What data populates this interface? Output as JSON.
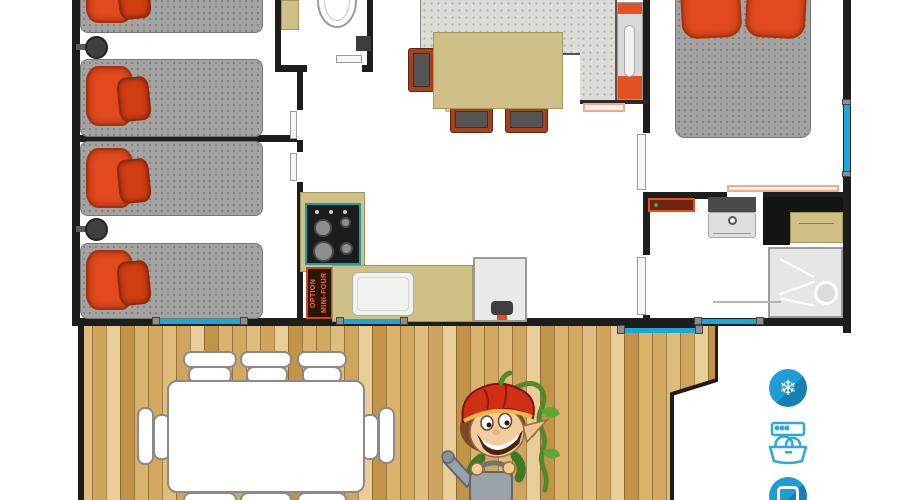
{
  "floorplan": {
    "kitchen": {
      "oven_option_label": "OPTION MINI-FOUR"
    },
    "amenities": [
      {
        "id": "air-conditioning",
        "glyph": "❄"
      },
      {
        "id": "dishwasher"
      },
      {
        "id": "tv"
      }
    ],
    "colors": {
      "wall": "#1d1d1b",
      "pillow_orange": "#e04a1c",
      "mattress_grey": "#a3a3a1",
      "counter_tan": "#cfc088",
      "worktop_grey": "#dcdcd8",
      "window_blue": "#19a8d8",
      "deck_wood": "#d5ad66",
      "amenity_blue": "#1f9ed6",
      "accent_orange": "#e2511f",
      "stove_teal": "#18a0a8"
    }
  }
}
